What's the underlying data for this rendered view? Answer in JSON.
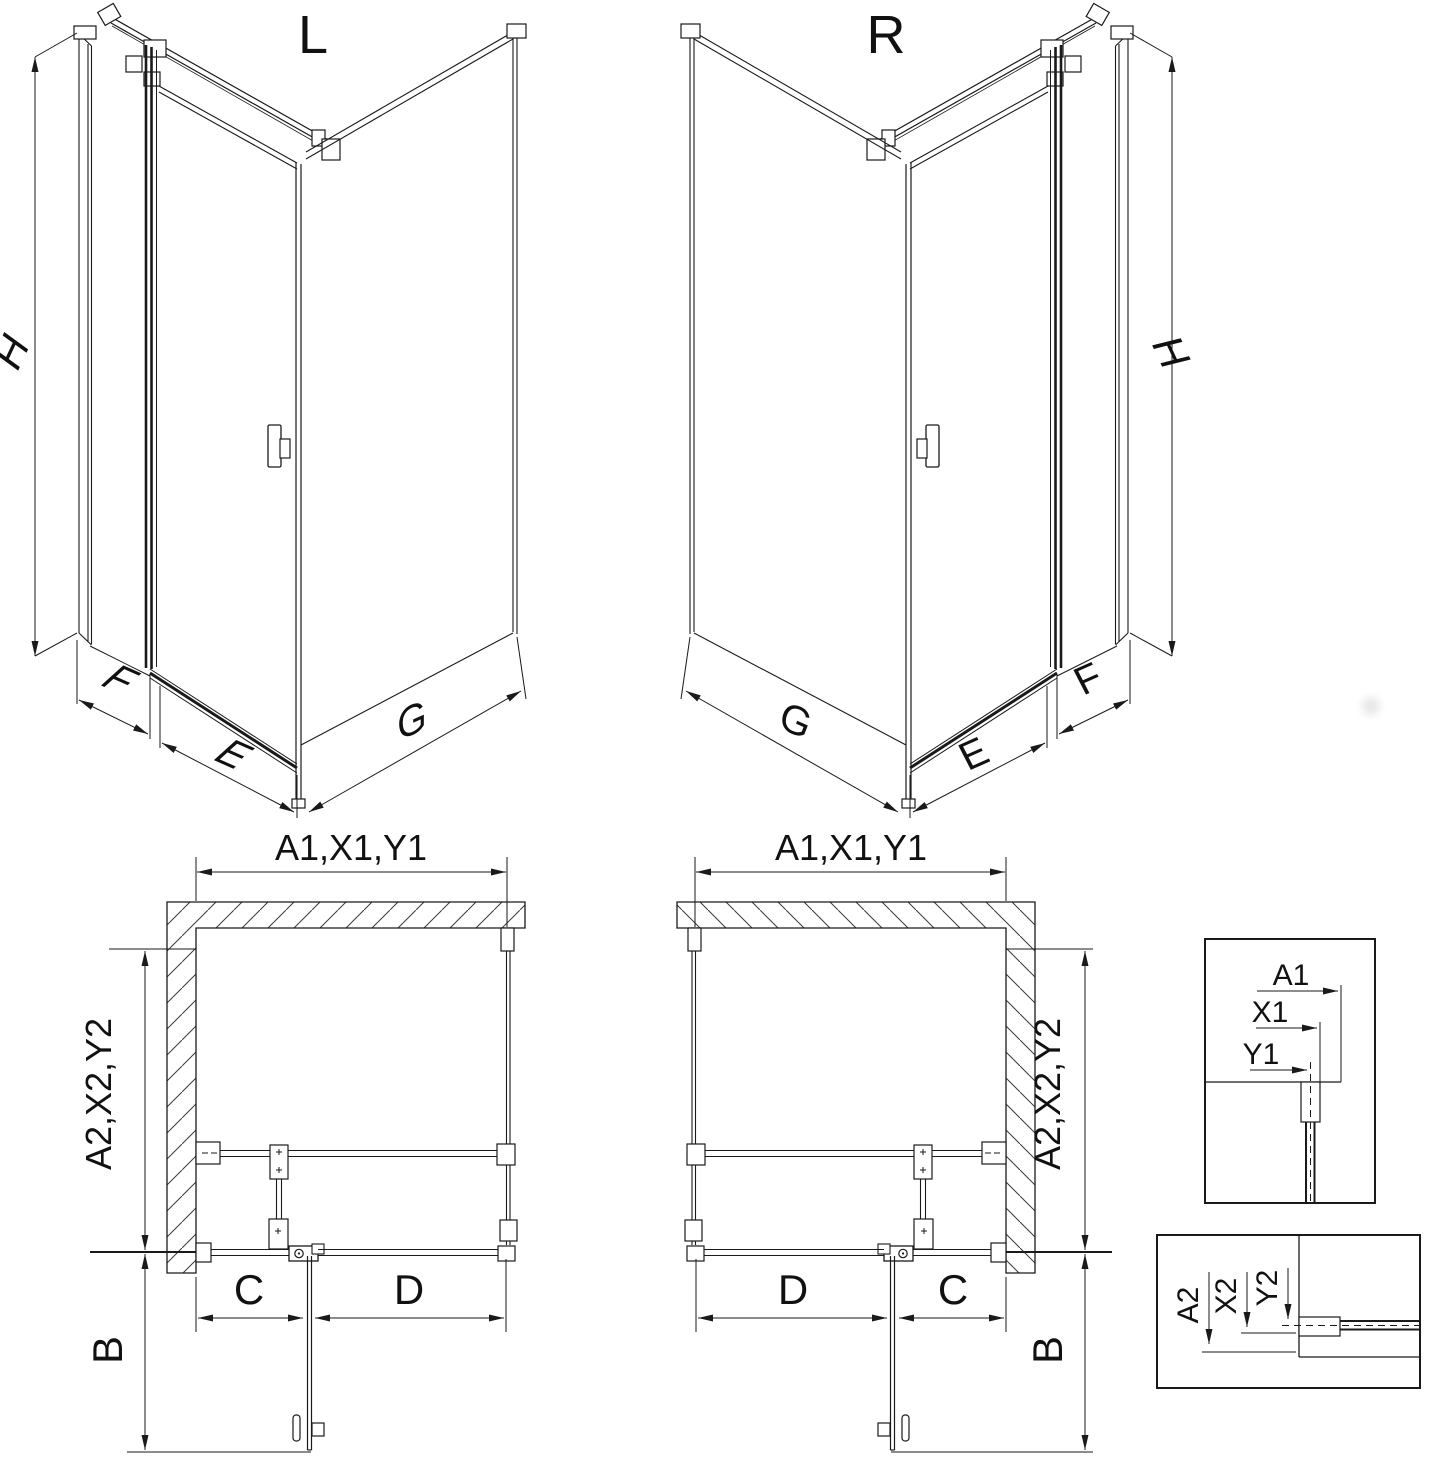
{
  "diagram": {
    "variant_labels": {
      "left": "L",
      "right": "R"
    },
    "iso_dimension_labels": {
      "height": "H",
      "panel_f": "F",
      "door_e": "E",
      "panel_g": "G"
    },
    "plan_dimension_labels": {
      "width_top": "A1,X1,Y1",
      "depth_side": "A2,X2,Y2",
      "door_swing": "B",
      "span_c": "C",
      "span_d": "D"
    },
    "detail_top": {
      "a1": "A1",
      "x1": "X1",
      "y1": "Y1"
    },
    "detail_bottom": {
      "a2": "A2",
      "x2": "X2",
      "y2": "Y2"
    }
  }
}
